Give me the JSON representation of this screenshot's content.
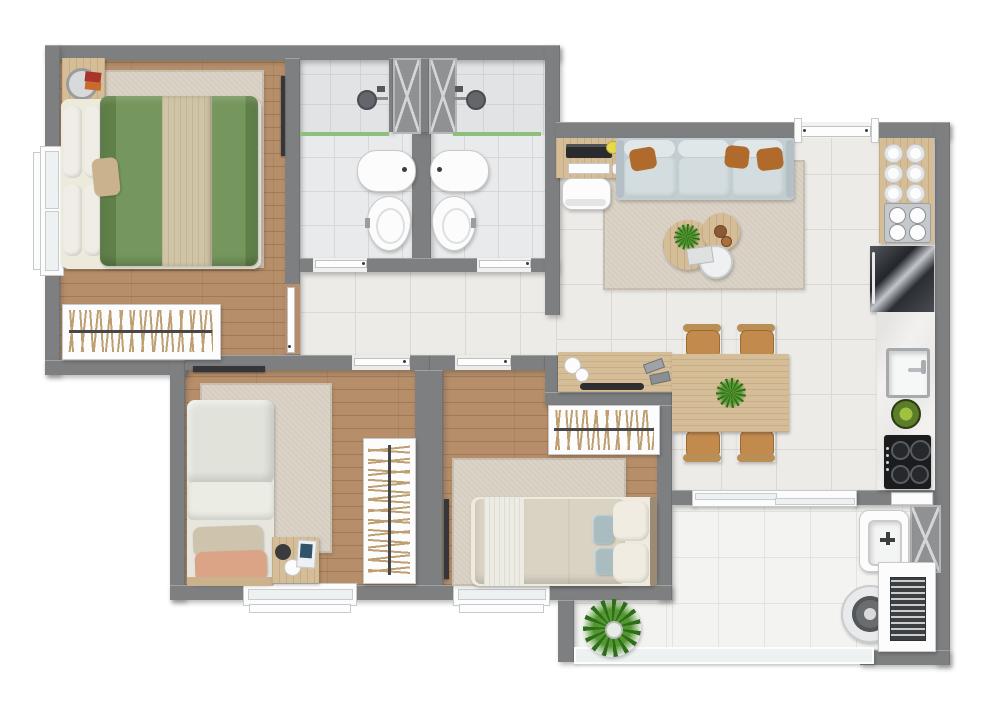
{
  "type": "3d-apartment-floor-plan-render",
  "colors": {
    "wall": "#7d7f81",
    "wood": "#b68e6a",
    "rug": "#dbd3c7",
    "tile_living": "#edebe7",
    "grout_living": "#dbd8d3",
    "tile_bath": "#e9eaeb",
    "grout_bath": "#d6d7d8",
    "tile_balcony": "#f3f3f1",
    "grout_balcony": "#e3e3e0",
    "duvet_green": "#75975d",
    "duvet_green_dark": "#5f8049",
    "runner_beige": "#cfc4a5",
    "pillow_white": "#efede6",
    "sofa_body": "#c3ced2",
    "sofa_seat": "#d3dde0",
    "sofa_back": "#dfe7e9",
    "cushion_orange": "#b06a2c",
    "wood_furn": "#d5bd97",
    "chair_seat": "#c28a4d",
    "chair_frame": "#b98f56",
    "plant": "#53982f",
    "plant_dark": "#2f6c1c",
    "appliance_dark": "#1b1c1e",
    "steel": "#c6c9cb",
    "fixture_white": "#fcfcfc",
    "fixture_ring": "#c7c9cb",
    "glass_green": "#8fbf7a",
    "glass_light": "#eef1f2",
    "hanger": "#bd9f72",
    "rail_dark": "#474747",
    "hardware": "#3b3c3e",
    "tv_dark": "#35363a",
    "book_red": "#a8352b",
    "book_orange": "#c96a2f",
    "magazine_blue": "#33536b",
    "pillow_beige": "#cec4ad",
    "pillow_salmon": "#dba486",
    "pillow_teal": "#a9bdc0",
    "marble": "#f2f1ef",
    "shaft": "#8f9193"
  },
  "rooms": [
    {
      "id": "master-bedroom",
      "name": "Master Bedroom",
      "furniture": [
        "double bed with green duvet and beige runner",
        "area rug",
        "nightstand with round tray and books",
        "open clothes rack with hangers",
        "wall-mounted tv",
        "side window"
      ]
    },
    {
      "id": "bathroom-1",
      "name": "Bathroom 1",
      "furniture": [
        "shower with green glass partition",
        "wash basin",
        "toilet",
        "ventilation shaft"
      ]
    },
    {
      "id": "bathroom-2",
      "name": "Bathroom 2",
      "furniture": [
        "shower with green glass partition",
        "wash basin",
        "toilet",
        "ventilation shaft"
      ]
    },
    {
      "id": "hallway",
      "name": "Hallway",
      "furniture": []
    },
    {
      "id": "living-dining",
      "name": "Living / Dining Room",
      "furniture": [
        "desk with laptop, keyboard, mouse and chair",
        "three-seat sofa with orange cushions",
        "nesting coffee tables with plant and book",
        "area rug",
        "entry door",
        "sideboard with bowls and tray",
        "dining table for four with centerpiece plant"
      ]
    },
    {
      "id": "kitchen",
      "name": "Kitchen",
      "furniture": [
        "wood shelf with six plates",
        "stainless tray with four bowls",
        "refrigerator",
        "counter with square sink and faucet",
        "herb bowl",
        "four-burner gas cooktop"
      ]
    },
    {
      "id": "bedroom-2",
      "name": "Bedroom 2",
      "furniture": [
        "single bed with beige and salmon pillows",
        "area rug",
        "nightstand with lamp and magazine",
        "open wardrobe with hangers",
        "wall-mounted tv",
        "bottom window"
      ]
    },
    {
      "id": "bedroom-3",
      "name": "Bedroom 3",
      "furniture": [
        "single bed with white and teal pillows",
        "area rug",
        "open wardrobe with hangers",
        "wall-mounted tv",
        "bottom window"
      ]
    },
    {
      "id": "balcony",
      "name": "Balcony",
      "furniture": [
        "potted plant",
        "glass railing",
        "sliding glass door"
      ]
    },
    {
      "id": "laundry",
      "name": "Laundry Area",
      "furniture": [
        "laundry tub with faucet",
        "round washing machine",
        "vented utility cabinet",
        "ventilation shaft"
      ]
    }
  ]
}
